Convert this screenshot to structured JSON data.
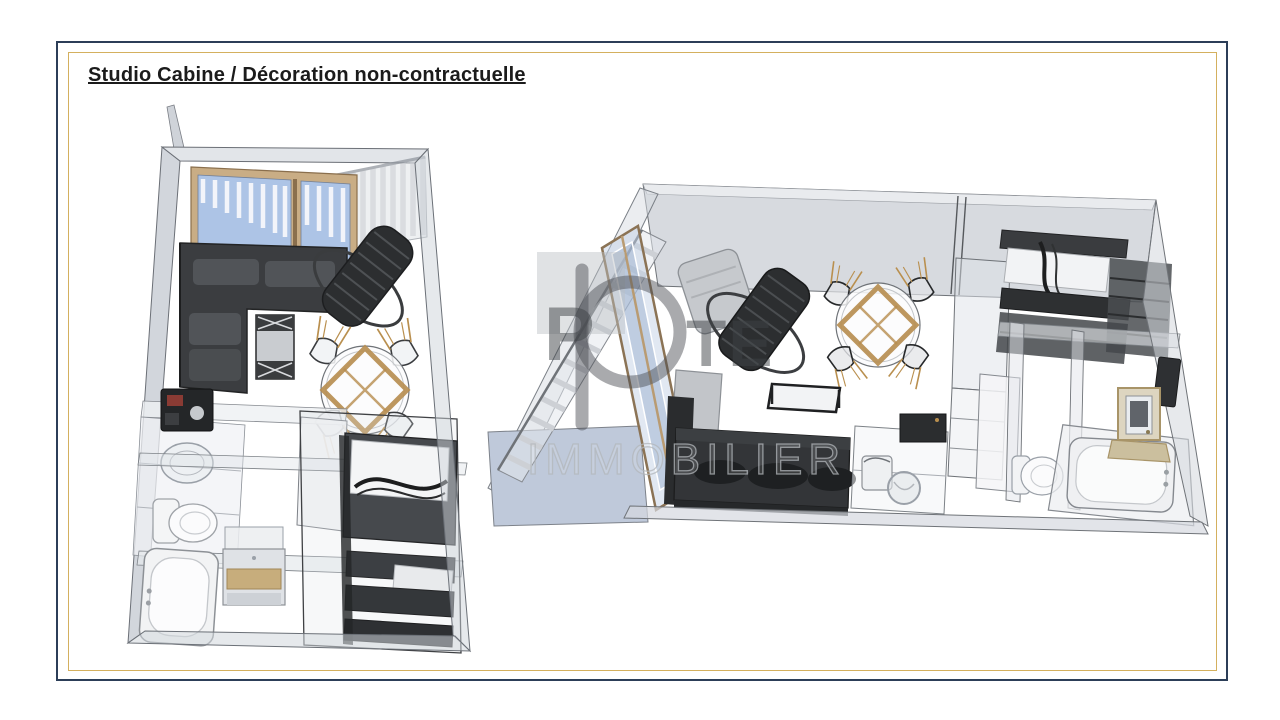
{
  "page": {
    "title": "Studio Cabine / Décoration non-contractuelle"
  },
  "watermark": {
    "letter_p": "P",
    "letters_te": "TE",
    "line2": "IMMOBILIER"
  },
  "colors": {
    "frame_outer": "#2c3e58",
    "frame_inner": "#d4b05e",
    "glass_blue": "#adc4e6",
    "wood": "#c9ad85",
    "accent_gold": "#b68c4e",
    "wall_gray": "#d7dadf",
    "furniture_dark": "#2f3133"
  }
}
